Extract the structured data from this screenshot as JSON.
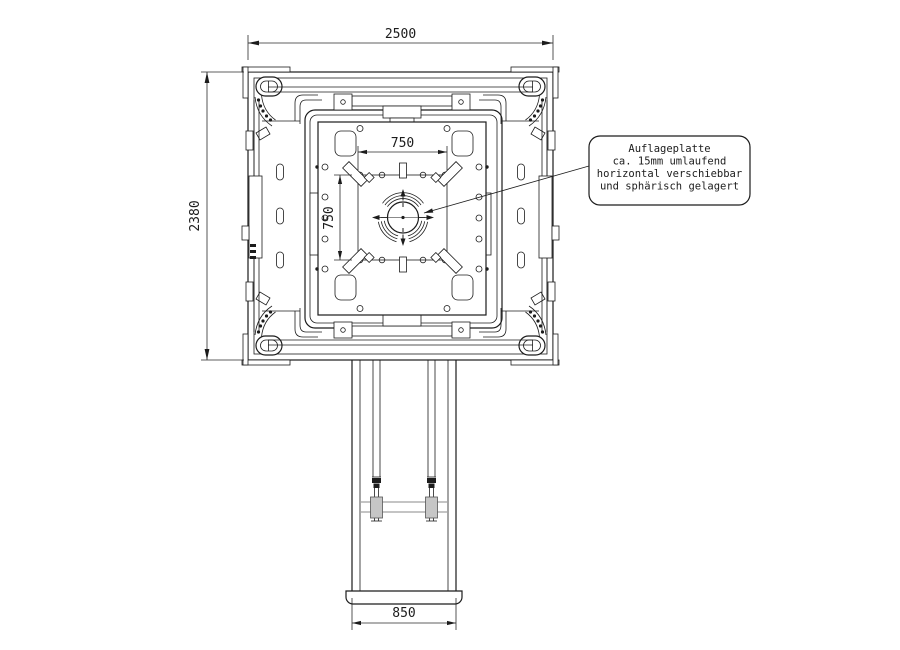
{
  "drawing": {
    "type": "technical-drawing-top-view",
    "dimensions": {
      "overall_width": "2500",
      "overall_height": "2380",
      "plate_width": "750",
      "plate_height": "750",
      "column_width": "850"
    },
    "annotation": {
      "lines": [
        "Auflageplatte",
        "ca. 15mm umlaufend",
        "horizontal verschiebbar",
        "und sphärisch gelagert"
      ]
    },
    "colors": {
      "line": "#1c1c1c",
      "background": "#ffffff",
      "gray_detail": "#8a8a8a"
    }
  }
}
